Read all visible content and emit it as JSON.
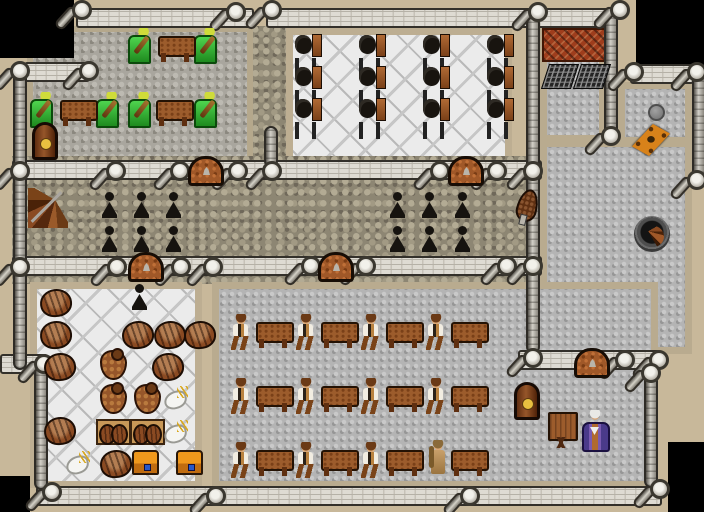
{
  "meta": {
    "view": "top-down tile map",
    "canvas": {
      "width": 704,
      "height": 512,
      "tile_size": 32
    }
  },
  "palette": {
    "void": "#000000",
    "rock_border": "#c8b89a",
    "wall_band": "#dedbd3",
    "cobble_dark": "#8d8673",
    "cobble_light": "#b4b4b4",
    "marble": "#ebebeb",
    "wood": "#9c5c2c",
    "door": "#a05828",
    "brick": "#9e3d1c",
    "chair_green": "#2fae2f",
    "chest_orange": "#f0981c",
    "robe_purple": "#7a5ab0"
  },
  "floors": [
    {
      "style": "cobble-dark",
      "x": 252,
      "y": 26,
      "w": 38,
      "h": 136
    },
    {
      "style": "cobble-music",
      "x": 27,
      "y": 26,
      "w": 226,
      "h": 136
    },
    {
      "style": "marble",
      "x": 286,
      "y": 28,
      "w": 226,
      "h": 136
    },
    {
      "style": "cobble-dark",
      "x": 12,
      "y": 156,
      "w": 530,
      "h": 128
    },
    {
      "style": "cobble-light",
      "x": 540,
      "y": 26,
      "w": 66,
      "h": 116
    },
    {
      "style": "cobble-light",
      "x": 618,
      "y": 82,
      "w": 74,
      "h": 62
    },
    {
      "style": "cobble-light",
      "x": 540,
      "y": 140,
      "w": 152,
      "h": 214
    },
    {
      "style": "cobble-light",
      "x": 212,
      "y": 282,
      "w": 446,
      "h": 206
    },
    {
      "style": "marble",
      "x": 30,
      "y": 282,
      "w": 172,
      "h": 206
    },
    {
      "style": "brick",
      "x": 542,
      "y": 28,
      "w": 66,
      "h": 34
    }
  ],
  "voids": [
    {
      "x": 0,
      "y": 0,
      "w": 74,
      "h": 58
    },
    {
      "x": 636,
      "y": 0,
      "w": 68,
      "h": 66
    },
    {
      "x": 0,
      "y": 476,
      "w": 30,
      "h": 36
    },
    {
      "x": 668,
      "y": 442,
      "w": 36,
      "h": 70
    }
  ],
  "walls_h": [
    {
      "x": 76,
      "y": 8,
      "w": 178
    },
    {
      "x": 266,
      "y": 8,
      "w": 348
    },
    {
      "x": 24,
      "y": 62,
      "w": 66
    },
    {
      "x": 12,
      "y": 160,
      "w": 530
    },
    {
      "x": 12,
      "y": 256,
      "w": 530
    },
    {
      "x": 630,
      "y": 64,
      "w": 64
    },
    {
      "x": 518,
      "y": 350,
      "w": 142
    },
    {
      "x": 36,
      "y": 486,
      "w": 626
    },
    {
      "x": 0,
      "y": 354,
      "w": 48
    }
  ],
  "walls_v": [
    {
      "x": 13,
      "y": 62,
      "h": 308
    },
    {
      "x": 34,
      "y": 364,
      "h": 126
    },
    {
      "x": 264,
      "y": 126,
      "h": 42
    },
    {
      "x": 526,
      "y": 16,
      "h": 338
    },
    {
      "x": 604,
      "y": 10,
      "h": 130
    },
    {
      "x": 692,
      "y": 70,
      "h": 112
    },
    {
      "x": 644,
      "y": 374,
      "h": 114
    }
  ],
  "pillars": [
    [
      82,
      10
    ],
    [
      236,
      12
    ],
    [
      272,
      10
    ],
    [
      538,
      12
    ],
    [
      620,
      10
    ],
    [
      20,
      71
    ],
    [
      89,
      71
    ],
    [
      20,
      171
    ],
    [
      116,
      171
    ],
    [
      180,
      171
    ],
    [
      238,
      171
    ],
    [
      272,
      171
    ],
    [
      440,
      171
    ],
    [
      497,
      171
    ],
    [
      533,
      171
    ],
    [
      20,
      267
    ],
    [
      117,
      267
    ],
    [
      181,
      267
    ],
    [
      213,
      267
    ],
    [
      311,
      266
    ],
    [
      366,
      266
    ],
    [
      507,
      266
    ],
    [
      533,
      266
    ],
    [
      634,
      72
    ],
    [
      697,
      72
    ],
    [
      611,
      136
    ],
    [
      697,
      180
    ],
    [
      533,
      358
    ],
    [
      625,
      360
    ],
    [
      659,
      360
    ],
    [
      44,
      364
    ],
    [
      651,
      373
    ],
    [
      52,
      492
    ],
    [
      216,
      496
    ],
    [
      470,
      496
    ],
    [
      660,
      489
    ]
  ],
  "doors": [
    {
      "x": 188,
      "y": 156
    },
    {
      "x": 448,
      "y": 156
    },
    {
      "x": 128,
      "y": 252
    },
    {
      "x": 318,
      "y": 252
    },
    {
      "x": 574,
      "y": 348
    }
  ],
  "entity_types": {
    "musician": {
      "label": "figure seated in green chair with lute",
      "interactable": true
    },
    "peasant": {
      "label": "standing villager in white shirt",
      "interactable": true
    },
    "woman": {
      "label": "standing woman in tan dress",
      "interactable": true
    },
    "wizard": {
      "label": "elder in purple robe",
      "interactable": true
    },
    "table": {
      "label": "wooden table",
      "interactable": false
    },
    "desk": {
      "label": "writing desk",
      "interactable": false
    },
    "loom": {
      "label": "loom chair",
      "interactable": false
    },
    "candle": {
      "label": "black candlestick",
      "interactable": false
    },
    "clock": {
      "label": "grandfather clock",
      "interactable": false
    },
    "stairs-wood": {
      "label": "wooden spiral stairs",
      "interactable": true
    },
    "stairs-dark": {
      "label": "stone stairwell down",
      "interactable": true
    },
    "barrel": {
      "label": "barrel",
      "interactable": false
    },
    "sack": {
      "label": "sack",
      "interactable": false
    },
    "crate": {
      "label": "crate of barrels",
      "interactable": false
    },
    "fowl": {
      "label": "plucked fowl",
      "interactable": false
    },
    "chest": {
      "label": "treasure chest",
      "interactable": true
    },
    "bellows": {
      "label": "bellows",
      "interactable": false
    },
    "grate": {
      "label": "floor grate",
      "interactable": false
    },
    "hole": {
      "label": "round hole",
      "interactable": true
    },
    "trapdoor": {
      "label": "wooden trapdoor",
      "interactable": true
    }
  },
  "entities": [
    {
      "t": "musician",
      "x": 128,
      "y": 28
    },
    {
      "t": "musician",
      "x": 194,
      "y": 28
    },
    {
      "t": "musician",
      "x": 30,
      "y": 92
    },
    {
      "t": "musician",
      "x": 96,
      "y": 92
    },
    {
      "t": "musician",
      "x": 128,
      "y": 92
    },
    {
      "t": "musician",
      "x": 194,
      "y": 92
    },
    {
      "t": "table",
      "x": 158,
      "y": 36
    },
    {
      "t": "table",
      "x": 60,
      "y": 100
    },
    {
      "t": "table",
      "x": 156,
      "y": 100
    },
    {
      "t": "clock",
      "x": 32,
      "y": 122
    },
    {
      "t": "clock",
      "x": 514,
      "y": 382
    },
    {
      "t": "stairs-wood",
      "x": 28,
      "y": 188
    },
    {
      "t": "stairs-dark",
      "x": 634,
      "y": 216
    },
    {
      "t": "loom",
      "x": 294,
      "y": 32
    },
    {
      "t": "loom",
      "x": 358,
      "y": 32
    },
    {
      "t": "loom",
      "x": 422,
      "y": 32
    },
    {
      "t": "loom",
      "x": 486,
      "y": 32
    },
    {
      "t": "loom",
      "x": 294,
      "y": 64
    },
    {
      "t": "loom",
      "x": 358,
      "y": 64
    },
    {
      "t": "loom",
      "x": 422,
      "y": 64
    },
    {
      "t": "loom",
      "x": 486,
      "y": 64
    },
    {
      "t": "loom",
      "x": 294,
      "y": 96
    },
    {
      "t": "loom",
      "x": 358,
      "y": 96
    },
    {
      "t": "loom",
      "x": 422,
      "y": 96
    },
    {
      "t": "loom",
      "x": 486,
      "y": 96
    },
    {
      "t": "candle",
      "x": 102,
      "y": 192
    },
    {
      "t": "candle",
      "x": 134,
      "y": 192
    },
    {
      "t": "candle",
      "x": 166,
      "y": 192
    },
    {
      "t": "candle",
      "x": 102,
      "y": 226
    },
    {
      "t": "candle",
      "x": 134,
      "y": 226
    },
    {
      "t": "candle",
      "x": 166,
      "y": 226
    },
    {
      "t": "candle",
      "x": 390,
      "y": 192
    },
    {
      "t": "candle",
      "x": 422,
      "y": 192
    },
    {
      "t": "candle",
      "x": 455,
      "y": 192
    },
    {
      "t": "candle",
      "x": 390,
      "y": 226
    },
    {
      "t": "candle",
      "x": 422,
      "y": 226
    },
    {
      "t": "candle",
      "x": 455,
      "y": 226
    },
    {
      "t": "candle",
      "x": 132,
      "y": 284
    },
    {
      "t": "grate",
      "x": 545,
      "y": 64
    },
    {
      "t": "grate",
      "x": 577,
      "y": 64
    },
    {
      "t": "hole",
      "x": 648,
      "y": 104
    },
    {
      "t": "trapdoor",
      "x": 632,
      "y": 124
    },
    {
      "t": "bellows",
      "x": 517,
      "y": 189
    },
    {
      "t": "barrel",
      "x": 40,
      "y": 289
    },
    {
      "t": "barrel",
      "x": 40,
      "y": 321
    },
    {
      "t": "barrel",
      "x": 122,
      "y": 321
    },
    {
      "t": "barrel",
      "x": 154,
      "y": 321
    },
    {
      "t": "barrel",
      "x": 184,
      "y": 321
    },
    {
      "t": "barrel",
      "x": 44,
      "y": 353
    },
    {
      "t": "sack",
      "x": 100,
      "y": 350
    },
    {
      "t": "barrel",
      "x": 152,
      "y": 353
    },
    {
      "t": "sack",
      "x": 100,
      "y": 384
    },
    {
      "t": "sack",
      "x": 134,
      "y": 384
    },
    {
      "t": "fowl",
      "x": 164,
      "y": 386
    },
    {
      "t": "barrel",
      "x": 44,
      "y": 417
    },
    {
      "t": "crate",
      "x": 96,
      "y": 419
    },
    {
      "t": "crate",
      "x": 130,
      "y": 419
    },
    {
      "t": "fowl",
      "x": 164,
      "y": 420
    },
    {
      "t": "fowl",
      "x": 66,
      "y": 451
    },
    {
      "t": "barrel",
      "x": 100,
      "y": 450
    },
    {
      "t": "chest",
      "x": 132,
      "y": 450
    },
    {
      "t": "chest",
      "x": 176,
      "y": 450
    },
    {
      "t": "peasant",
      "x": 230,
      "y": 314
    },
    {
      "t": "table",
      "x": 256,
      "y": 322
    },
    {
      "t": "peasant",
      "x": 295,
      "y": 314
    },
    {
      "t": "table",
      "x": 321,
      "y": 322
    },
    {
      "t": "peasant",
      "x": 360,
      "y": 314
    },
    {
      "t": "table",
      "x": 386,
      "y": 322
    },
    {
      "t": "peasant",
      "x": 425,
      "y": 314
    },
    {
      "t": "table",
      "x": 451,
      "y": 322
    },
    {
      "t": "peasant",
      "x": 230,
      "y": 378
    },
    {
      "t": "table",
      "x": 256,
      "y": 386
    },
    {
      "t": "peasant",
      "x": 295,
      "y": 378
    },
    {
      "t": "table",
      "x": 321,
      "y": 386
    },
    {
      "t": "peasant",
      "x": 360,
      "y": 378
    },
    {
      "t": "table",
      "x": 386,
      "y": 386
    },
    {
      "t": "peasant",
      "x": 425,
      "y": 378
    },
    {
      "t": "table",
      "x": 451,
      "y": 386
    },
    {
      "t": "peasant",
      "x": 230,
      "y": 442
    },
    {
      "t": "table",
      "x": 256,
      "y": 450
    },
    {
      "t": "peasant",
      "x": 295,
      "y": 442
    },
    {
      "t": "table",
      "x": 321,
      "y": 450
    },
    {
      "t": "peasant",
      "x": 360,
      "y": 442
    },
    {
      "t": "table",
      "x": 386,
      "y": 450
    },
    {
      "t": "woman",
      "x": 427,
      "y": 440
    },
    {
      "t": "table",
      "x": 451,
      "y": 450
    },
    {
      "t": "desk",
      "x": 546,
      "y": 412
    },
    {
      "t": "wizard",
      "x": 581,
      "y": 410
    }
  ]
}
